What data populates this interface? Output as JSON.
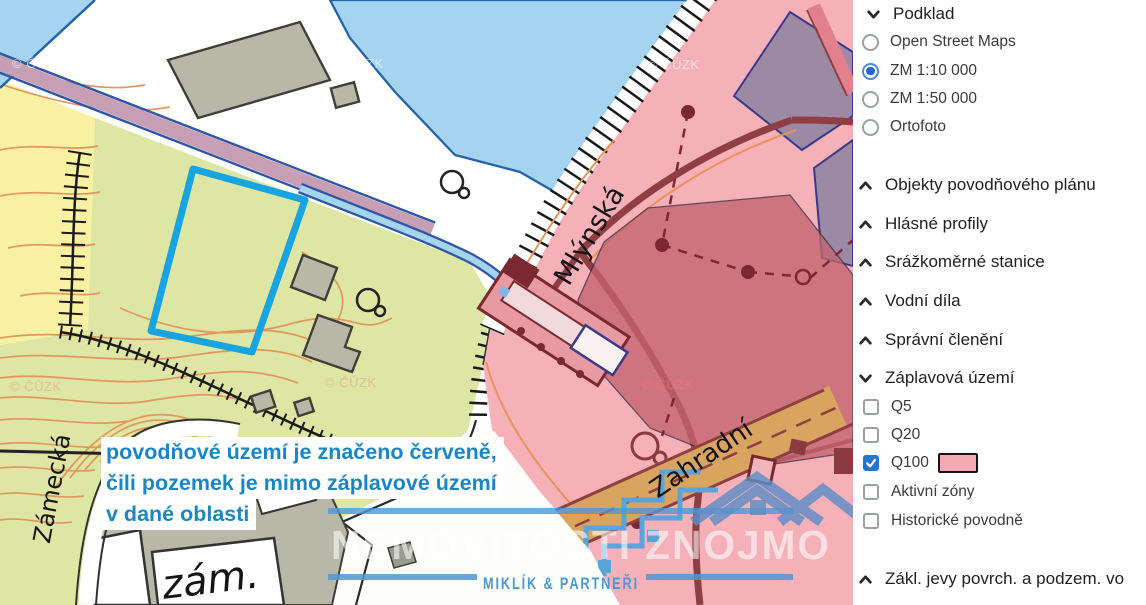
{
  "sidebar": {
    "basemap": {
      "title": "Podklad",
      "options": [
        {
          "label": "Open Street Maps",
          "selected": false
        },
        {
          "label": "ZM 1:10 000",
          "selected": true
        },
        {
          "label": "ZM 1:50 000",
          "selected": false
        },
        {
          "label": "Ortofoto",
          "selected": false
        }
      ]
    },
    "collapsed_sections": [
      "Objekty povodňového plánu",
      "Hlásné profily",
      "Srážkoměrné stanice",
      "Vodní díla",
      "Správní členění"
    ],
    "flood_areas": {
      "title": "Záplavová území",
      "items": [
        {
          "label": "Q5",
          "checked": false
        },
        {
          "label": "Q20",
          "checked": false
        },
        {
          "label": "Q100",
          "checked": true
        },
        {
          "label": "Aktivní zóny",
          "checked": false
        },
        {
          "label": "Historické povodně",
          "checked": false
        }
      ],
      "q100_swatch_color": "#f5a9b2"
    },
    "bottom_section": "Zákl. jevy povrch. a podzem. vo"
  },
  "map": {
    "labels": {
      "mlynska": "Mlýnská",
      "zahradni": "Zahradní",
      "zamecka": "Zámecká",
      "zamek": "zám."
    },
    "copyright": "© ČÚZK",
    "annotation": {
      "line1": "povodňové území je značeno červeně,",
      "line2": "čili pozemek je mimo záplavové území",
      "line3": "v dané oblasti",
      "text_color": "#1a86c5"
    },
    "watermark": {
      "title": "NEMOVITOSTI ZNOJMO",
      "subtitle": "MIKLÍK & PARTNEŘI",
      "accent_color": "#4f97d3"
    },
    "parcel_outline_color": "#18a3e1",
    "q100_fill": "#f6b0b8"
  }
}
